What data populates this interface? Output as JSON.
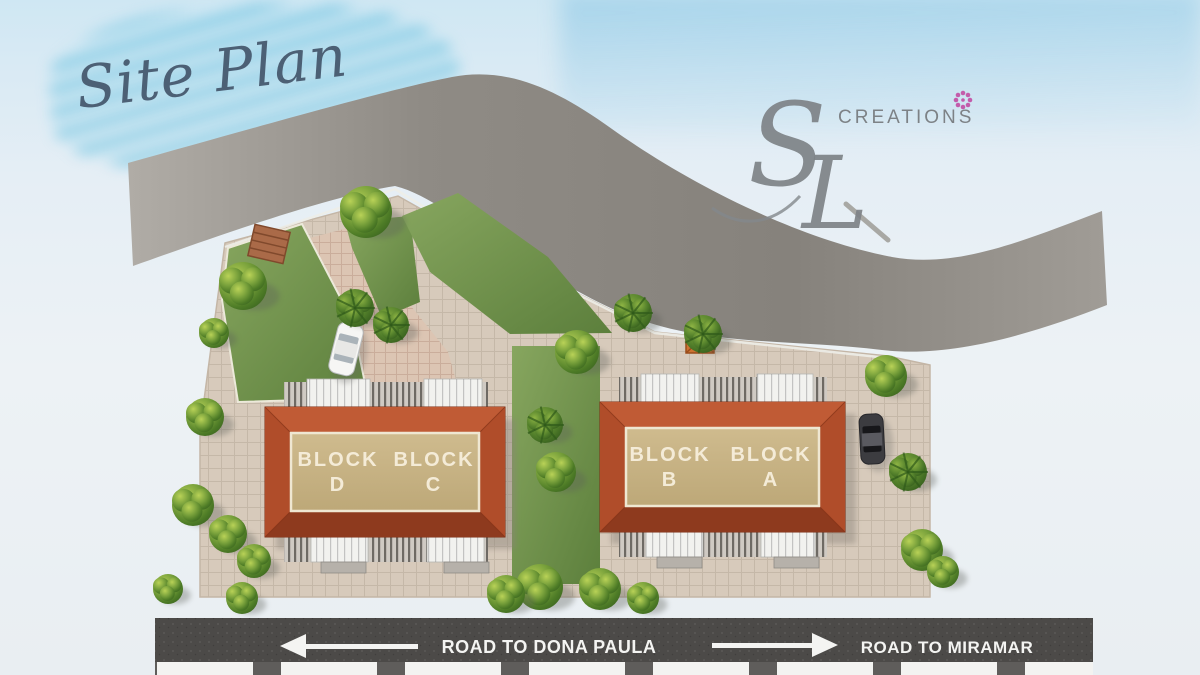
{
  "title": "Site Plan",
  "brand": {
    "monogram_s": "S",
    "monogram_l": "L",
    "name": "CREATIONS",
    "flower_glyph": "✻"
  },
  "site": {
    "blocks": [
      {
        "word": "BLOCK",
        "letter": "D"
      },
      {
        "word": "BLOCK",
        "letter": "C"
      },
      {
        "word": "BLOCK",
        "letter": "B"
      },
      {
        "word": "BLOCK",
        "letter": "A"
      }
    ]
  },
  "roads": {
    "bottom_left": {
      "label": "ROAD TO DONA PAULA",
      "direction": "left"
    },
    "bottom_right": {
      "label": "ROAD TO MIRAMAR",
      "direction": "right"
    }
  },
  "colors": {
    "sky_wash": "#bfe3f2",
    "top_road": "#8d8983",
    "bottom_road": "#4a4846",
    "roof": "#a84828",
    "roof_inner": "#c9b487",
    "lawn": "#6f9247",
    "paving": "#d7cabb",
    "logo_flower": "#c95fae",
    "text_on_road": "#ffffff"
  }
}
